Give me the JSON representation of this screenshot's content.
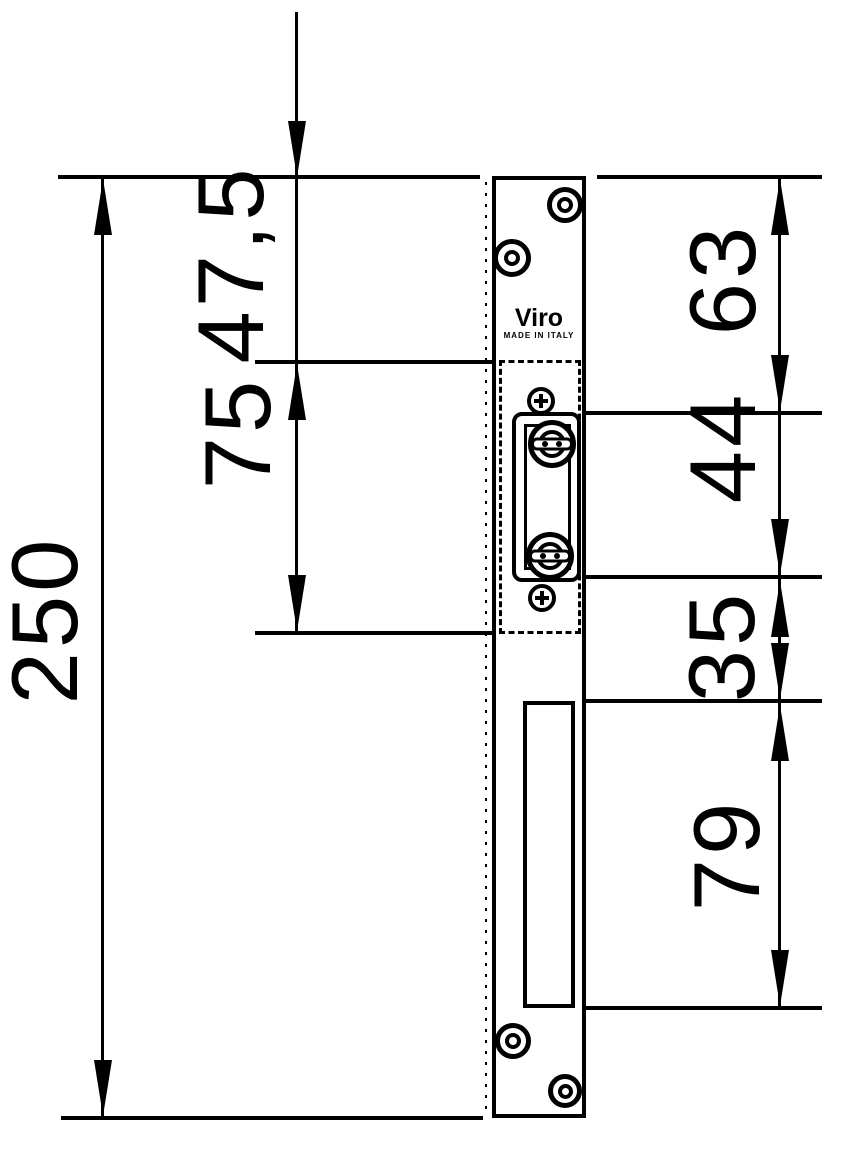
{
  "drawing": {
    "type": "technical-dimension-drawing",
    "subject": "Electric door strike faceplate, front view with stacked vertical dimensions (mm)",
    "background_color": "#ffffff",
    "line_color": "#000000",
    "dims": {
      "overall": "250",
      "top_to_keep_area": "47,5",
      "keep_area_height": "75",
      "top_to_latch_bottom": "63",
      "latch_height": "44",
      "latch_to_cutout": "35",
      "cutout_height": "79"
    },
    "plate": {
      "brand": "Viro",
      "made_in": "MADE IN ITALY"
    }
  }
}
